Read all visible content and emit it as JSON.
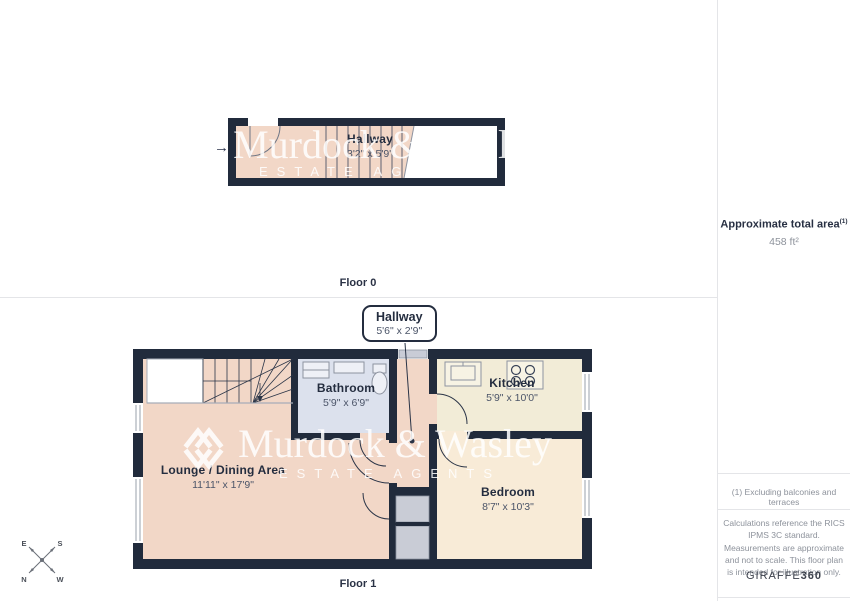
{
  "colors": {
    "wall": "#212b3c",
    "lounge_pink": "#f2d7c7",
    "kitchen_cream": "#f2ecd7",
    "bedroom_cream": "#f8ebd7",
    "bathroom_blue": "#dce1ed",
    "vestibule_gray": "#c9ccd6",
    "text_dark": "#242d3f",
    "text_muted": "#8d929b",
    "divider": "#e4e5e8",
    "watermark": "#ffffff"
  },
  "floor0": {
    "label": "Floor 0",
    "room": {
      "name": "Hallway",
      "dims": "3'2\" x 5'9\""
    }
  },
  "floor1": {
    "label": "Floor 1",
    "callout": {
      "name": "Hallway",
      "dims": "5'6\" x 2'9\""
    },
    "rooms": {
      "bathroom": {
        "name": "Bathroom",
        "dims": "5'9\" x 6'9\""
      },
      "kitchen": {
        "name": "Kitchen",
        "dims": "5'9\" x 10'0\""
      },
      "lounge": {
        "name": "Lounge / Dining Area",
        "dims": "11'11\" x 17'9\""
      },
      "bedroom": {
        "name": "Bedroom",
        "dims": "8'7\" x 10'3\""
      }
    }
  },
  "sidebar": {
    "total_area_label": "Approximate total area",
    "total_area_sup": "(1)",
    "total_area_value": "458 ft²",
    "footnote": "(1) Excluding balconies and terraces",
    "disclaimer": "Calculations reference the RICS IPMS 3C standard. Measurements are approximate and not to scale. This floor plan is intended for illustration only.",
    "brand_name": "GIRAFFE",
    "brand_suffix": "360"
  },
  "watermark": {
    "name": "Murdock & Wasley",
    "tagline": "ESTATE AGENTS"
  },
  "compass": {
    "n": "N",
    "e": "E",
    "s": "S",
    "w": "W"
  }
}
